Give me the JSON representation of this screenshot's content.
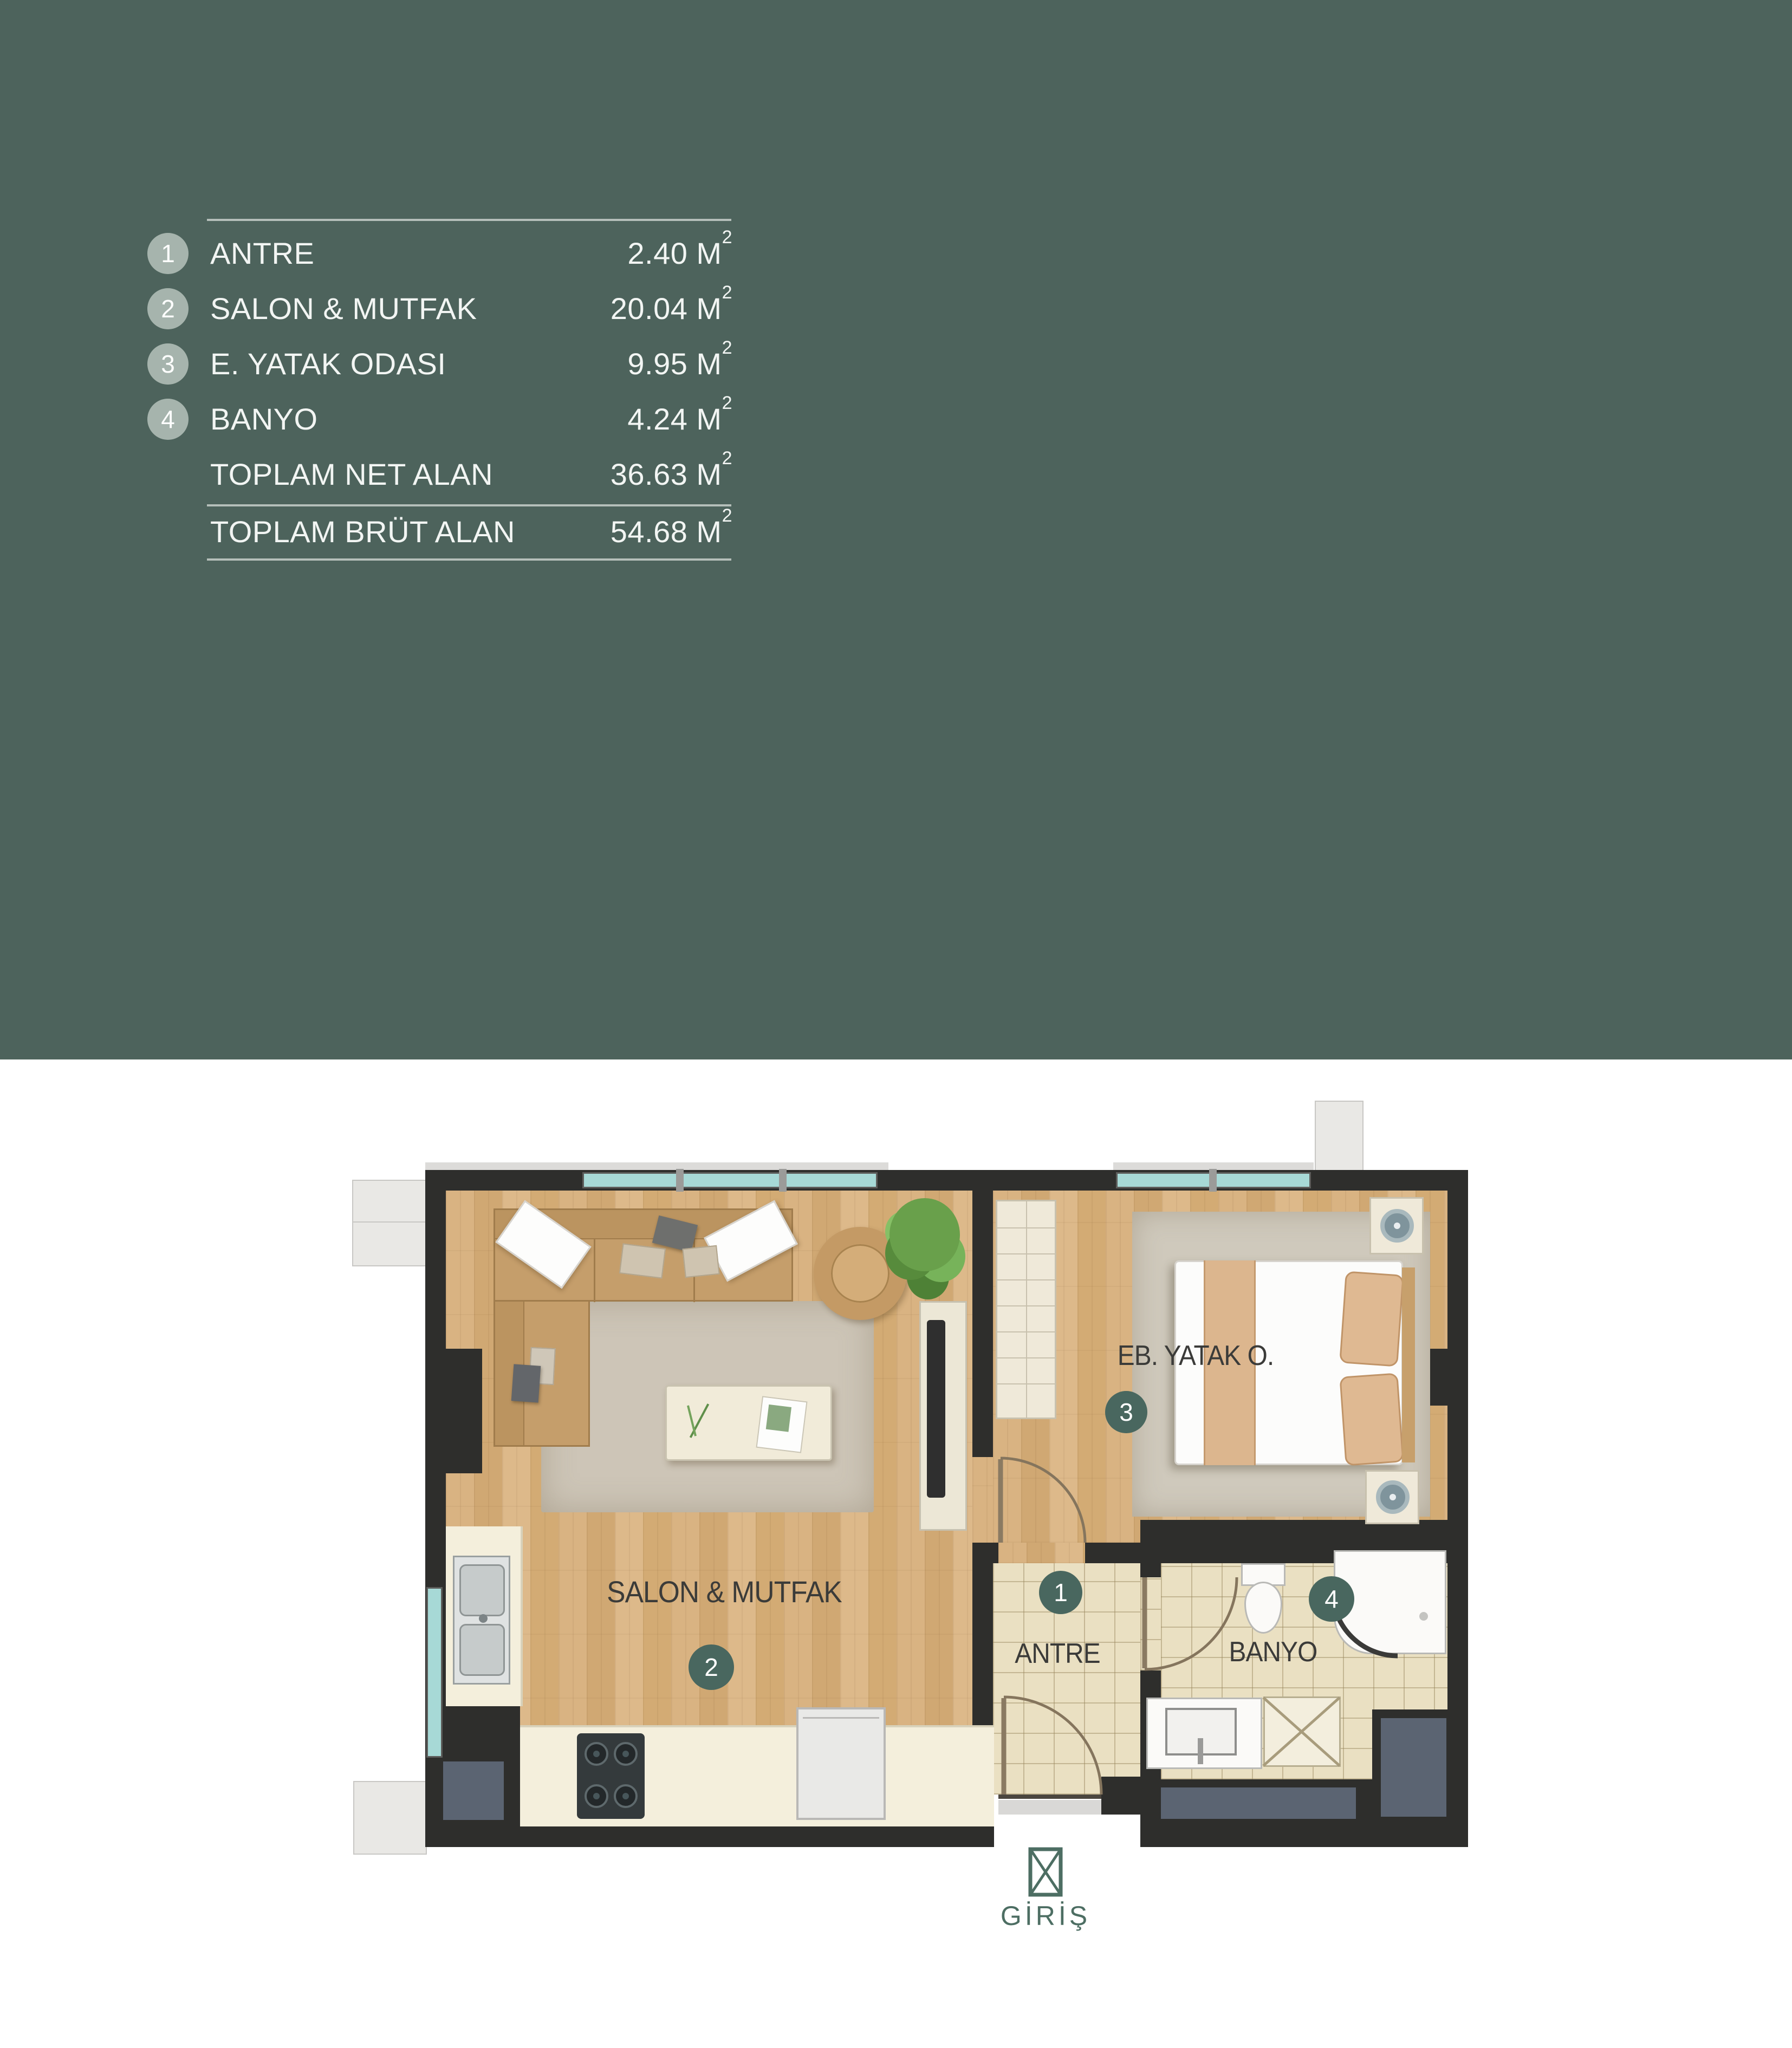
{
  "legend": {
    "rows": [
      {
        "num": "1",
        "label": "ANTRE",
        "value": "2.40",
        "unit": "M",
        "sup": "2"
      },
      {
        "num": "2",
        "label": "SALON & MUTFAK",
        "value": "20.04",
        "unit": "M",
        "sup": "2"
      },
      {
        "num": "3",
        "label": "E. YATAK ODASI",
        "value": "9.95",
        "unit": "M",
        "sup": "2"
      },
      {
        "num": "4",
        "label": "BANYO",
        "value": "4.24",
        "unit": "M",
        "sup": "2"
      },
      {
        "num": "",
        "label": "TOPLAM NET ALAN",
        "value": "36.63",
        "unit": "M",
        "sup": "2"
      },
      {
        "num": "",
        "label": "TOPLAM BRÜT ALAN",
        "value": "54.68",
        "unit": "M",
        "sup": "2"
      }
    ]
  },
  "plan": {
    "rooms": {
      "salon": {
        "label": "SALON & MUTFAK",
        "badge": "2"
      },
      "bedroom": {
        "label": "EB. YATAK O.",
        "badge": "3"
      },
      "antre": {
        "label": "ANTRE",
        "badge": "1"
      },
      "banyo": {
        "label": "BANYO",
        "badge": "4"
      }
    },
    "entrance": {
      "label": "GİRİŞ"
    }
  },
  "theme": {
    "panel_green": "#4d635c",
    "line_gray": "#b5bfba",
    "legend_badge_gray": "#a6b4ad",
    "plan_badge_teal": "#49675f",
    "entrance_green": "#4d6e63",
    "wall_dark": "#2e2e2c",
    "wood": "#d5ae79",
    "tile_beige": "#eae0c2",
    "shaft_slate": "#5b6472"
  }
}
